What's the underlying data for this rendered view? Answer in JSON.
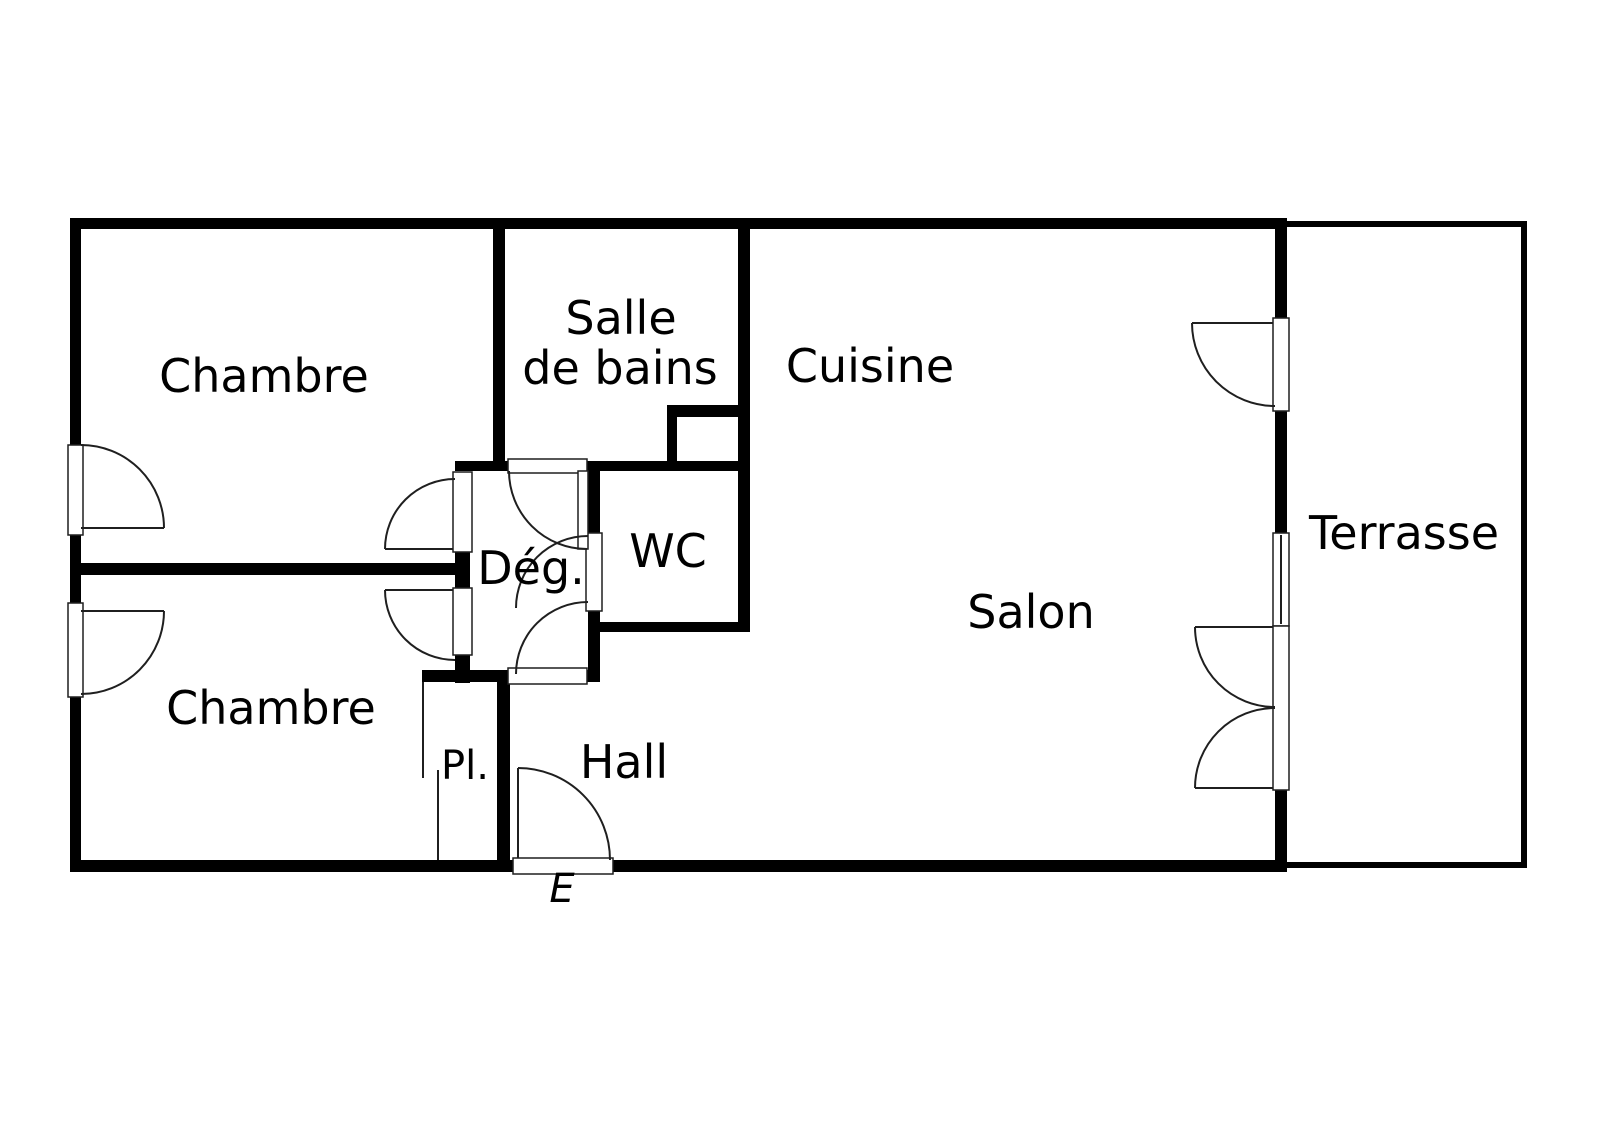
{
  "plan": {
    "canvas": {
      "w": 1600,
      "h": 1130
    },
    "colors": {
      "bg": "#ffffff",
      "wall": "#000000",
      "line": "#1f1f1f",
      "text": "#000000"
    },
    "font": {
      "size": 46
    },
    "labels": [
      {
        "id": "room-chambre-1",
        "text": "Chambre",
        "x": 264,
        "y": 392
      },
      {
        "id": "room-salle-de-bains-line1",
        "text": "Salle",
        "x": 621,
        "y": 334
      },
      {
        "id": "room-salle-de-bains-line2",
        "text": "de bains",
        "x": 620,
        "y": 384
      },
      {
        "id": "room-cuisine",
        "text": "Cuisine",
        "x": 870,
        "y": 382
      },
      {
        "id": "room-wc",
        "text": "WC",
        "x": 668,
        "y": 567
      },
      {
        "id": "room-degagement",
        "text": "Dég.",
        "x": 531,
        "y": 584
      },
      {
        "id": "room-salon",
        "text": "Salon",
        "x": 1031,
        "y": 628
      },
      {
        "id": "room-chambre-2",
        "text": "Chambre",
        "x": 271,
        "y": 724
      },
      {
        "id": "room-placard",
        "text": "Pl.",
        "x": 465,
        "y": 779,
        "size": 40
      },
      {
        "id": "room-hall",
        "text": "Hall",
        "x": 624,
        "y": 778
      },
      {
        "id": "room-terrasse",
        "text": "Terrasse",
        "x": 1404,
        "y": 549
      },
      {
        "id": "entrance-marker",
        "text": "E",
        "x": 562,
        "y": 902,
        "size": 40,
        "style": "italic"
      }
    ],
    "walls": [
      {
        "id": "wall-top",
        "x": 70,
        "y": 218,
        "w": 1217,
        "h": 11
      },
      {
        "id": "wall-left-1",
        "x": 70,
        "y": 218,
        "w": 11,
        "h": 227
      },
      {
        "id": "wall-left-2",
        "x": 70,
        "y": 535,
        "w": 11,
        "h": 68
      },
      {
        "id": "wall-left-3",
        "x": 70,
        "y": 697,
        "w": 11,
        "h": 175
      },
      {
        "id": "wall-bottom-1",
        "x": 70,
        "y": 860,
        "w": 443,
        "h": 12
      },
      {
        "id": "wall-bottom-2",
        "x": 613,
        "y": 860,
        "w": 674,
        "h": 12
      },
      {
        "id": "wall-right-1",
        "x": 1275,
        "y": 218,
        "w": 12,
        "h": 100
      },
      {
        "id": "wall-right-2",
        "x": 1275,
        "y": 411,
        "w": 12,
        "h": 122
      },
      {
        "id": "wall-right-3",
        "x": 1275,
        "y": 790,
        "w": 12,
        "h": 72
      },
      {
        "id": "wall-between-chambres",
        "x": 70,
        "y": 563,
        "w": 400,
        "h": 12
      },
      {
        "id": "wall-sdb-left",
        "x": 493,
        "y": 218,
        "w": 12,
        "h": 253
      },
      {
        "id": "wall-mid-1",
        "x": 455,
        "y": 461,
        "w": 53,
        "h": 10
      },
      {
        "id": "wall-mid-2",
        "x": 587,
        "y": 461,
        "w": 153,
        "h": 10
      },
      {
        "id": "wall-duct-top",
        "x": 667,
        "y": 405,
        "w": 81,
        "h": 12
      },
      {
        "id": "wall-duct-left",
        "x": 667,
        "y": 405,
        "w": 10,
        "h": 66
      },
      {
        "id": "wall-cuisine",
        "x": 738,
        "y": 218,
        "w": 12,
        "h": 414
      },
      {
        "id": "wall-wc-bottom",
        "x": 592,
        "y": 622,
        "w": 158,
        "h": 10
      },
      {
        "id": "wall-deg-right-1",
        "x": 588,
        "y": 461,
        "w": 12,
        "h": 72
      },
      {
        "id": "wall-deg-right-2",
        "x": 588,
        "y": 611,
        "w": 12,
        "h": 71
      },
      {
        "id": "wall-deg-left-1",
        "x": 455,
        "y": 552,
        "w": 15,
        "h": 36
      },
      {
        "id": "wall-deg-left-2",
        "x": 455,
        "y": 655,
        "w": 15,
        "h": 28
      },
      {
        "id": "wall-placard-top",
        "x": 422,
        "y": 670,
        "w": 86,
        "h": 12
      },
      {
        "id": "wall-deg-bottom",
        "x": 587,
        "y": 670,
        "w": 13,
        "h": 12
      },
      {
        "id": "wall-hall-left",
        "x": 497,
        "y": 670,
        "w": 13,
        "h": 202
      },
      {
        "id": "wall-terrasse-top",
        "x": 1287,
        "y": 221,
        "w": 240,
        "h": 6
      },
      {
        "id": "wall-terrasse-right",
        "x": 1521,
        "y": 221,
        "w": 6,
        "h": 647
      },
      {
        "id": "wall-terrasse-bottom",
        "x": 1287,
        "y": 862,
        "w": 240,
        "h": 6
      }
    ],
    "openings": [
      {
        "id": "opening-chambre1-left",
        "x": 68,
        "y": 445,
        "w": 15,
        "h": 90
      },
      {
        "id": "opening-chambre2-left",
        "x": 68,
        "y": 603,
        "w": 15,
        "h": 94
      },
      {
        "id": "opening-deg-chambre1",
        "x": 453,
        "y": 472,
        "w": 19,
        "h": 80
      },
      {
        "id": "opening-deg-chambre2",
        "x": 453,
        "y": 588,
        "w": 19,
        "h": 67
      },
      {
        "id": "opening-sdb-door",
        "x": 508,
        "y": 459,
        "w": 79,
        "h": 14
      },
      {
        "id": "opening-wc-door",
        "x": 586,
        "y": 533,
        "w": 16,
        "h": 78
      },
      {
        "id": "opening-deg-hall-door",
        "x": 508,
        "y": 668,
        "w": 79,
        "h": 16
      },
      {
        "id": "opening-entrance-door",
        "x": 513,
        "y": 858,
        "w": 100,
        "h": 16
      },
      {
        "id": "opening-terrasse-door",
        "x": 1273,
        "y": 318,
        "w": 16,
        "h": 93
      },
      {
        "id": "window-salon",
        "x": 1273,
        "y": 533,
        "w": 16,
        "h": 93
      },
      {
        "id": "opening-terrasse-double-door",
        "x": 1273,
        "y": 626,
        "w": 16,
        "h": 164
      },
      {
        "id": "leaf-sdb-door",
        "x": 578,
        "y": 471,
        "w": 10,
        "h": 78
      }
    ],
    "lines": [
      {
        "id": "leaf-chambre1-door",
        "x1": 81,
        "y1": 528,
        "x2": 164,
        "y2": 528
      },
      {
        "id": "leaf-chambre2-door",
        "x1": 81,
        "y1": 611,
        "x2": 164,
        "y2": 611
      },
      {
        "id": "leaf-deg-chambre1-door",
        "x1": 385,
        "y1": 549,
        "x2": 453,
        "y2": 549
      },
      {
        "id": "leaf-deg-chambre2-door",
        "x1": 385,
        "y1": 590,
        "x2": 453,
        "y2": 590
      },
      {
        "id": "leaf-entrance-door",
        "x1": 518,
        "y1": 768,
        "x2": 518,
        "y2": 858
      },
      {
        "id": "leaf-terrasse-door",
        "x1": 1192,
        "y1": 323,
        "x2": 1273,
        "y2": 323
      },
      {
        "id": "leaf-terrasse-double-top",
        "x1": 1195,
        "y1": 627,
        "x2": 1273,
        "y2": 627
      },
      {
        "id": "leaf-terrasse-double-bottom",
        "x1": 1195,
        "y1": 788,
        "x2": 1273,
        "y2": 788
      },
      {
        "id": "placard-sliding-door-1",
        "x1": 423,
        "y1": 682,
        "x2": 423,
        "y2": 778
      },
      {
        "id": "placard-sliding-door-2",
        "x1": 438,
        "y1": 770,
        "x2": 438,
        "y2": 860
      },
      {
        "id": "window-salon-midline",
        "x1": 1281,
        "y1": 535,
        "x2": 1281,
        "y2": 624
      }
    ],
    "arcs": [
      {
        "id": "arc-chambre1-door",
        "d": "M 164 528 A 83 83 0 0 0 81 445"
      },
      {
        "id": "arc-chambre2-door",
        "d": "M 164 611 A 83 83 0 0 1 81 694"
      },
      {
        "id": "arc-deg-chambre1-door",
        "d": "M 385 549 A 70 70 0 0 1 455 479"
      },
      {
        "id": "arc-deg-chambre2-door",
        "d": "M 385 590 A 70 70 0 0 0 455 660"
      },
      {
        "id": "arc-sdb-door",
        "d": "M 509 471 A 78 78 0 0 0 587 549"
      },
      {
        "id": "arc-wc-door",
        "d": "M 516 608 A 72 72 0 0 1 588 536"
      },
      {
        "id": "arc-deg-hall-door",
        "d": "M 516 674 A 72 72 0 0 1 588 602"
      },
      {
        "id": "arc-entrance-door",
        "d": "M 518 768 A 92 92 0 0 1 610 860"
      },
      {
        "id": "arc-terrasse-door",
        "d": "M 1192 323 A 83 83 0 0 0 1275 406"
      },
      {
        "id": "arc-terrasse-double-top",
        "d": "M 1195 627 A 80 80 0 0 0 1275 707"
      },
      {
        "id": "arc-terrasse-double-bottom",
        "d": "M 1195 788 A 80 80 0 0 1 1275 708"
      }
    ]
  }
}
